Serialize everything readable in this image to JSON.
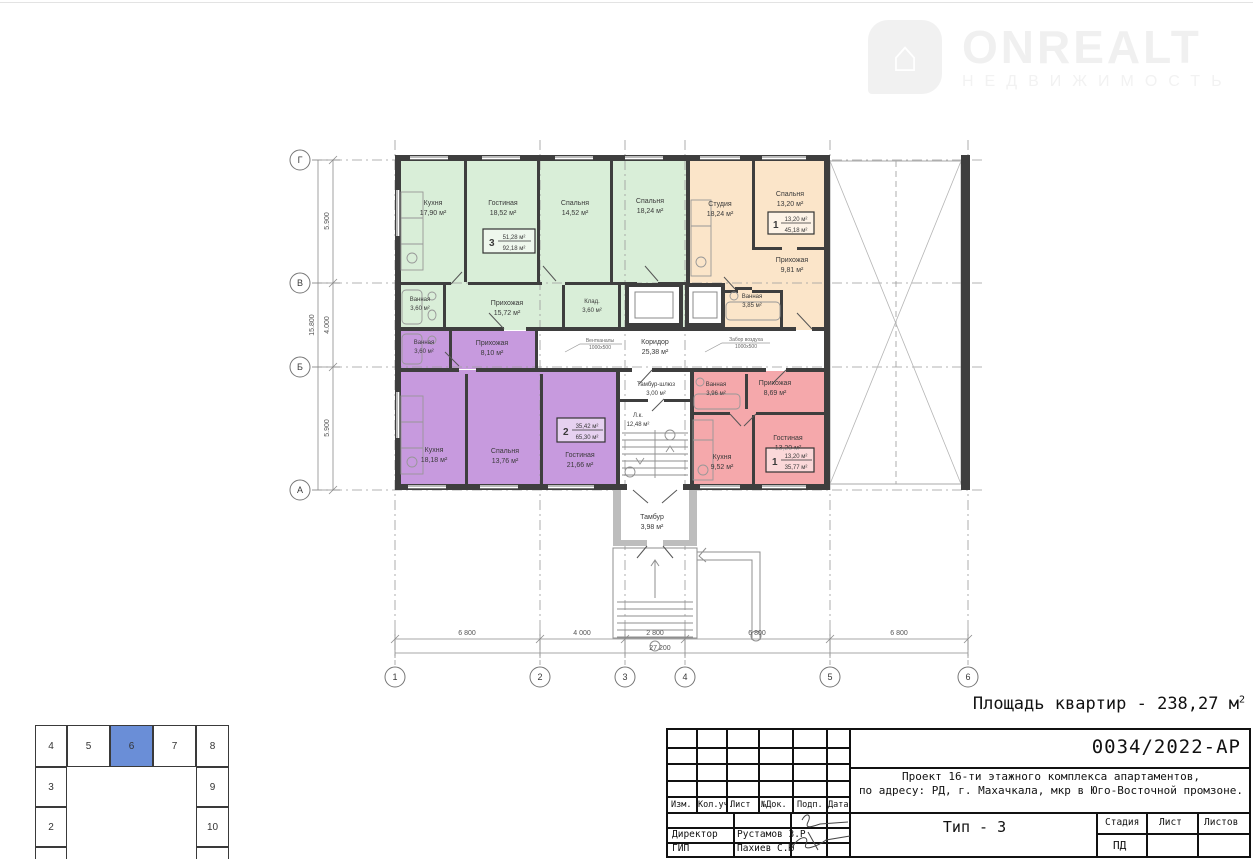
{
  "logo": {
    "brand": "ONREALT",
    "tagline": "НЕДВИЖИМОСТЬ",
    "house_glyph": "⌂"
  },
  "summary": {
    "text": "Площадь квартир - 238,27 м",
    "sup": "2"
  },
  "plan": {
    "axes": {
      "rows": [
        "Г",
        "В",
        "Б",
        "А"
      ],
      "cols": [
        "1",
        "2",
        "3",
        "4",
        "5",
        "6"
      ]
    },
    "dims": {
      "left": [
        "5.900",
        "4.000",
        "5.900"
      ],
      "left_total": "15.800",
      "bottom": [
        "6 800",
        "4 000",
        "2 800",
        "6 800",
        "6 800"
      ],
      "bottom_total": "27 200"
    },
    "colors": {
      "walls": "#3e3e3e",
      "apt3": "#d9eed8",
      "apt1top": "#fbe5c9",
      "apt2": "#c79ade",
      "apt1bottom": "#f5a8ab"
    },
    "apartments": [
      {
        "number": "3",
        "living": "51,28 м²",
        "total": "92,18 м²",
        "color": "#d9eed8",
        "rooms": [
          {
            "n": "Кухня",
            "a": "17,90 м²"
          },
          {
            "n": "Гостиная",
            "a": "18,52 м²"
          },
          {
            "n": "Спальня",
            "a": "14,52 м²"
          },
          {
            "n": "Спальня",
            "a": "18,24 м²"
          },
          {
            "n": "Ванная",
            "a": "3,60 м²"
          },
          {
            "n": "Прихожая",
            "a": "15,72 м²"
          },
          {
            "n": "Клад.",
            "a": "3,60 м²"
          }
        ]
      },
      {
        "number": "1",
        "living": "13,20 м²",
        "total": "45,18 м²",
        "color": "#fbe5c9",
        "rooms": [
          {
            "n": "Студия",
            "a": "18,24 м²"
          },
          {
            "n": "Спальня",
            "a": "13,20 м²"
          },
          {
            "n": "Прихожая",
            "a": "9,81 м²"
          },
          {
            "n": "Ванная",
            "a": "3,85 м²"
          }
        ]
      },
      {
        "number": "2",
        "living": "35,42 м²",
        "total": "65,30 м²",
        "color": "#c79ade",
        "rooms": [
          {
            "n": "Ванная",
            "a": "3,60 м²"
          },
          {
            "n": "Прихожая",
            "a": "8,10 м²"
          },
          {
            "n": "Кухня",
            "a": "18,18 м²"
          },
          {
            "n": "Спальня",
            "a": "13,76 м²"
          },
          {
            "n": "Гостиная",
            "a": "21,66 м²"
          }
        ]
      },
      {
        "number": "1",
        "living": "13,20 м²",
        "total": "35,77 м²",
        "color": "#f5a8ab",
        "rooms": [
          {
            "n": "Ванная",
            "a": "3,96 м²"
          },
          {
            "n": "Прихожая",
            "a": "8,69 м²"
          },
          {
            "n": "Кухня",
            "a": "9,52 м²"
          },
          {
            "n": "Гостиная",
            "a": "13,20 м²"
          }
        ]
      }
    ],
    "common": {
      "corridor": {
        "n": "Коридор",
        "a": "25,38 м²"
      },
      "tambour_lock": {
        "n": "Тамбур-шлюз",
        "a": "3,00 м²"
      },
      "stair": {
        "n": "Л.к.",
        "a": "12,48 м²"
      },
      "tambour": {
        "n": "Тамбур",
        "a": "3,98 м²"
      }
    },
    "annotations": {
      "left1": "Вентканалы",
      "left2": "1000х500",
      "right1": "Забор воздуха",
      "right2": "1000х500"
    }
  },
  "keyplan": {
    "top": [
      "4",
      "5",
      "6",
      "7",
      "8"
    ],
    "left": [
      "3",
      "2"
    ],
    "right": [
      "9",
      "10"
    ],
    "highlight": "6",
    "highlight_color": "#6a8ed7"
  },
  "titleblock": {
    "doc_number": "0034/2022-АР",
    "project_line1": "Проект 16-ти этажного комплекса апартаментов,",
    "project_line2": "по адресу: РД, г. Махачкала, мкр в Юго-Восточной промзоне.",
    "type_label": "Тип - 3",
    "columns": [
      "Изм.",
      "Кол.уч.",
      "Лист",
      "№Док.",
      "Подп.",
      "Дата"
    ],
    "stage_header": [
      "Стадия",
      "Лист",
      "Листов"
    ],
    "stage_value": "ПД",
    "roles": [
      {
        "role": "Директор",
        "name": "Рустамов З.Р"
      },
      {
        "role": "ГИП",
        "name": "Пахиев С.Ю"
      }
    ]
  }
}
